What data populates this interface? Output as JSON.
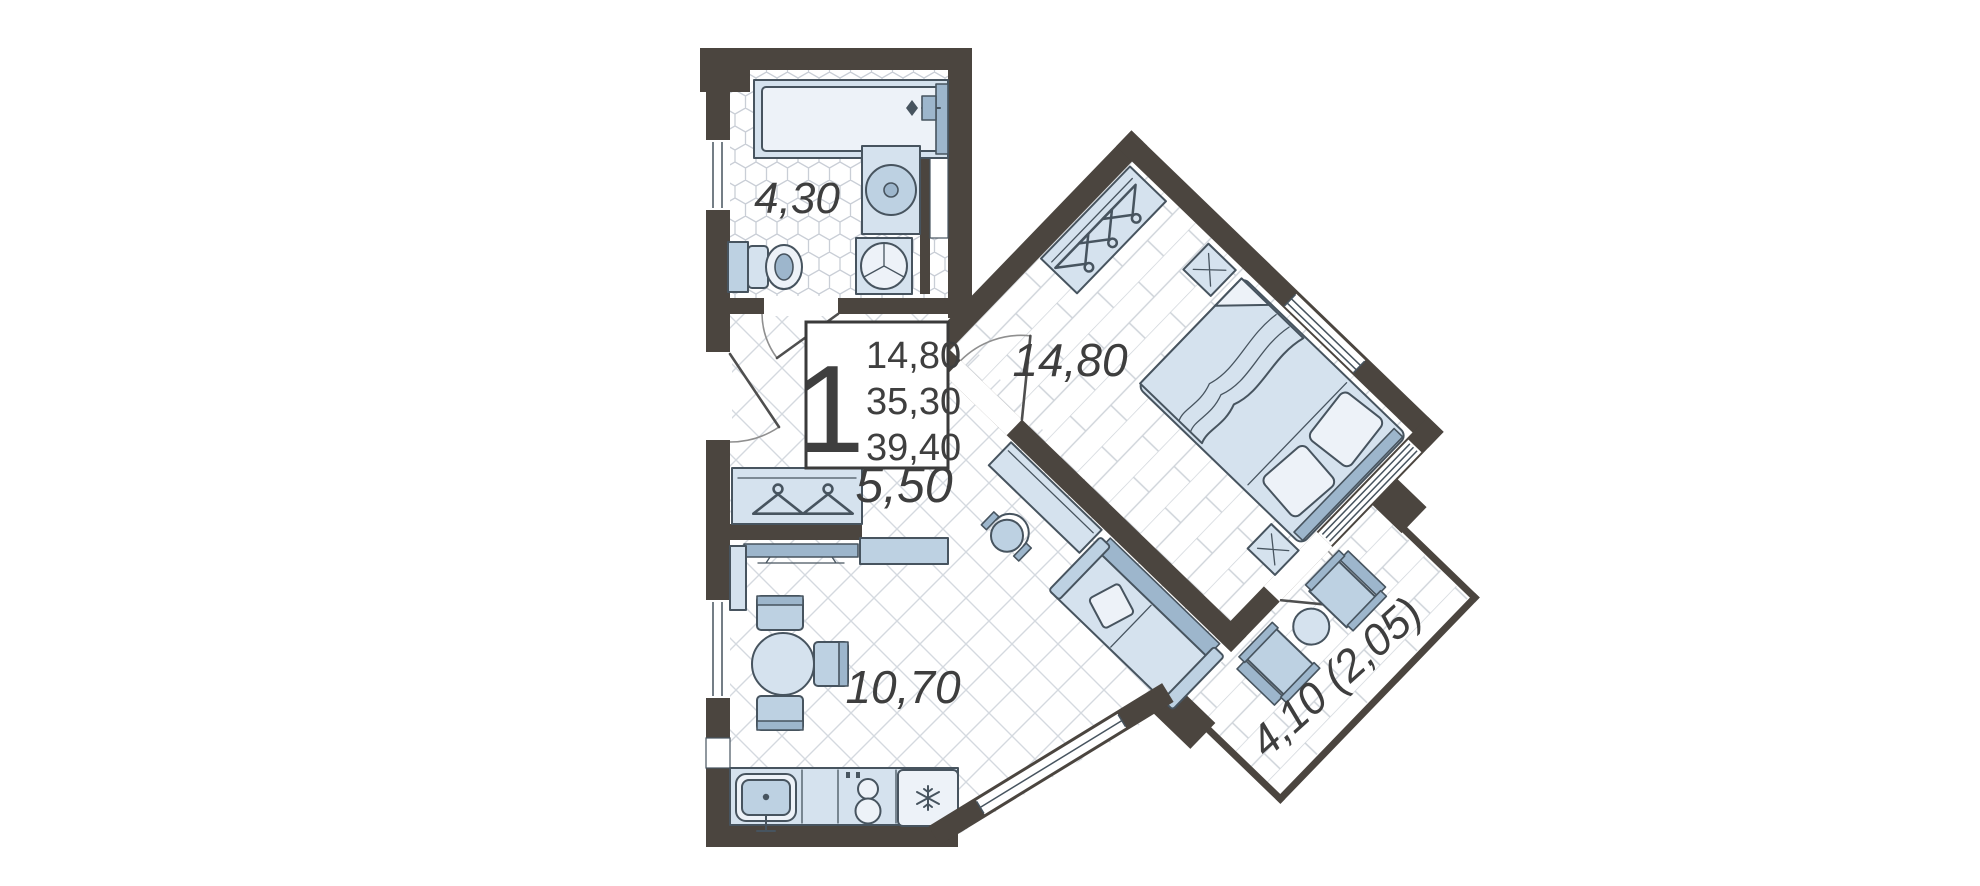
{
  "plan": {
    "info_box": {
      "rooms_count": "1",
      "areas": [
        "14,80",
        "35,30",
        "39,40"
      ]
    },
    "rooms": {
      "bathroom": {
        "label": "4,30"
      },
      "hallway": {
        "label": "5,50"
      },
      "bedroom": {
        "label": "14,80"
      },
      "kitchen_living": {
        "label": "10,70"
      },
      "balcony": {
        "label": "4,10 (2,05)"
      }
    },
    "colors": {
      "wall": "#4b453f",
      "furniture_light": "#d5e2ee",
      "furniture_mid": "#bdd1e2",
      "furniture_dark": "#9db6cc",
      "outline": "#47545f",
      "floor_line": "#d2d7dd",
      "label_text": "#3e3e3e"
    }
  }
}
